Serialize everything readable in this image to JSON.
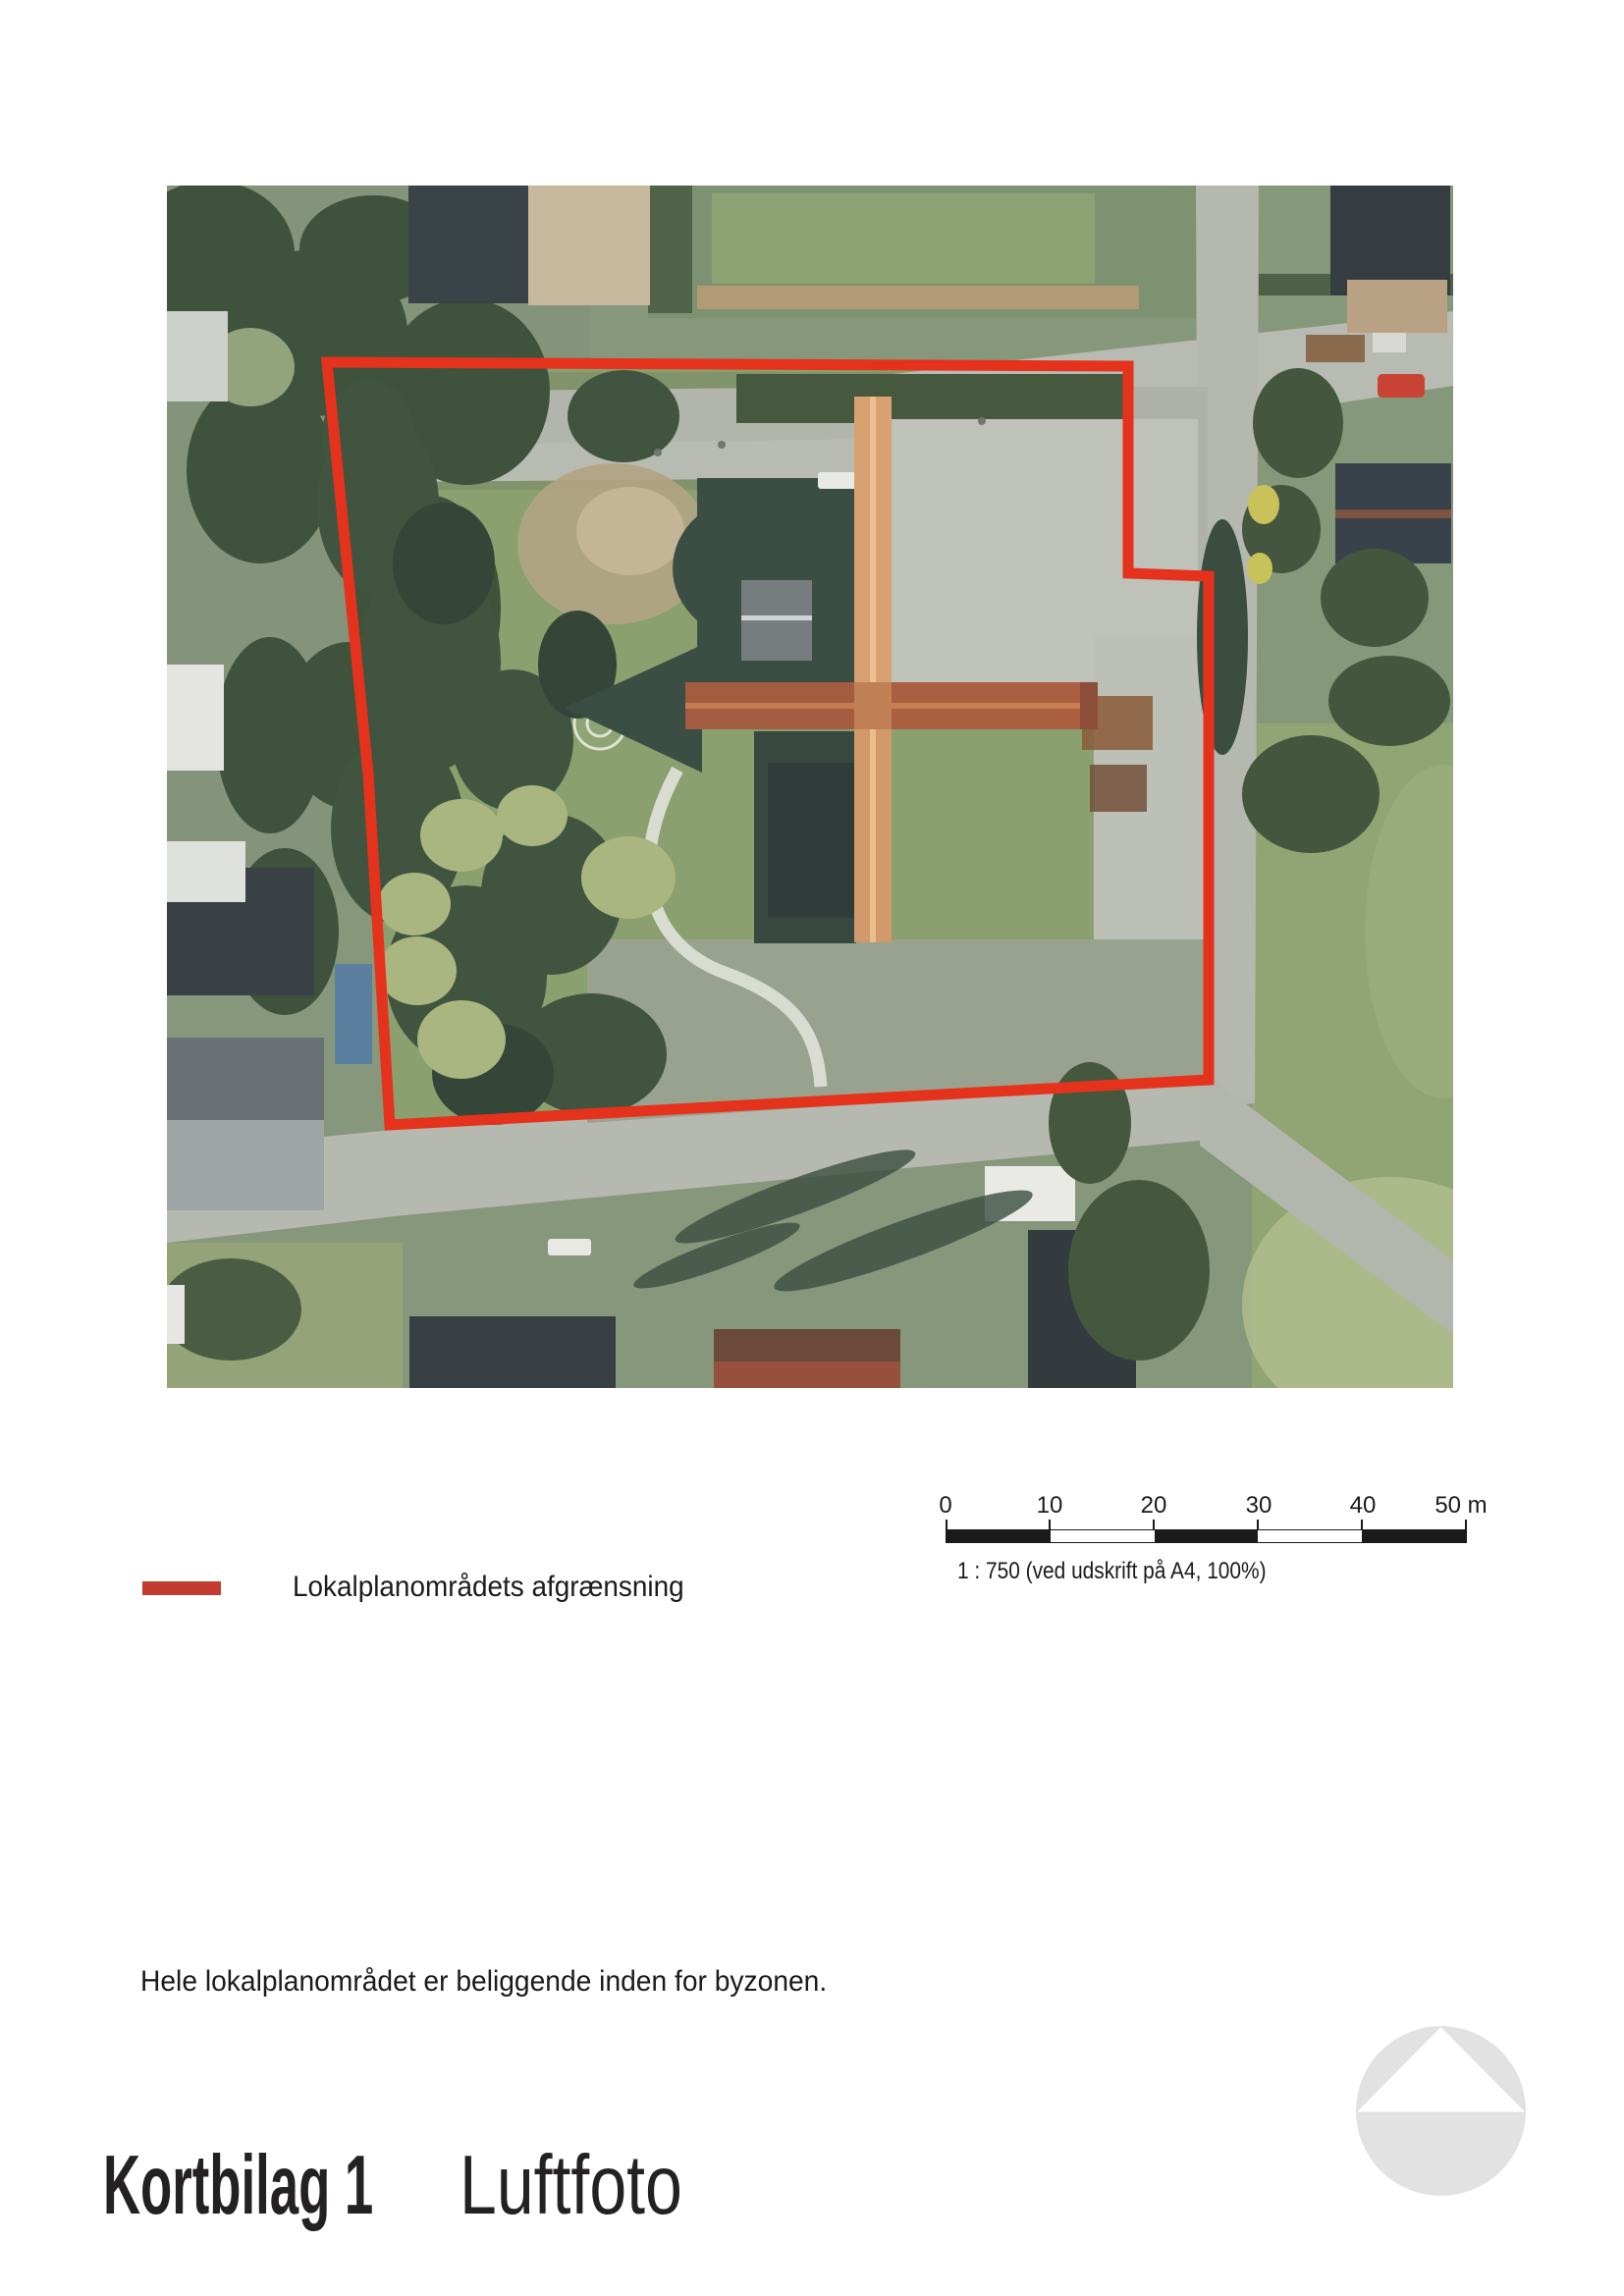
{
  "map": {
    "type": "aerial-photo",
    "boundary": {
      "color": "#e5321d",
      "label": "Lokalplanområdets afgrænsning"
    }
  },
  "legend": {
    "swatch_color": "#c43b2f",
    "label": "Lokalplanområdets afgrænsning"
  },
  "scalebar": {
    "tick_labels": [
      "0",
      "10",
      "20",
      "30",
      "40",
      "50 m"
    ],
    "caption": "1 : 750 (ved udskrift på A4, 100%)",
    "bar_color": "#1a1a1a"
  },
  "note": "Hele lokalplanområdet er beliggende inden for byzonen.",
  "title": {
    "bold": "Kortbilag 1",
    "regular": "Luftfoto"
  },
  "logo": {
    "color": "#e2e2e2"
  }
}
